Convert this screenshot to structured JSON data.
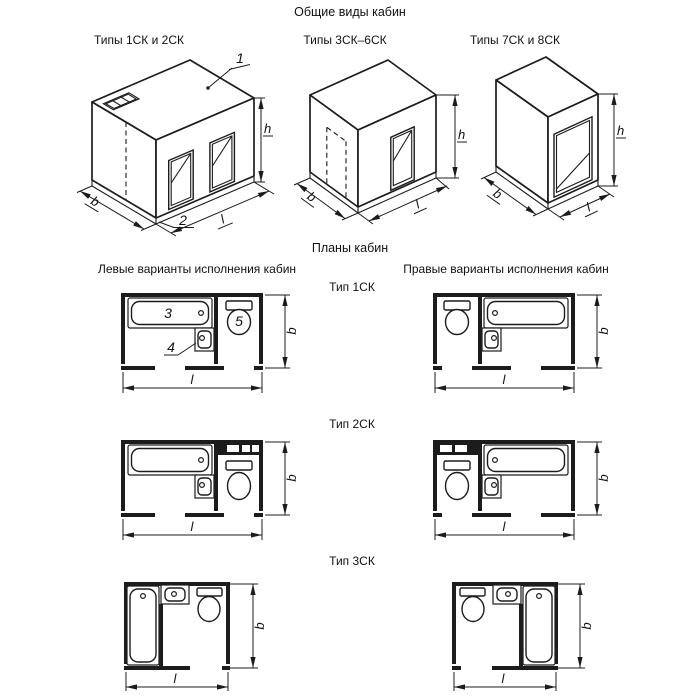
{
  "page": {
    "bg": "#ffffff",
    "ink": "#1c1c1c",
    "title": "Общие виды кабин",
    "plans_title": "Планы кабин",
    "left_variants_title": "Левые варианты исполнения кабин",
    "right_variants_title": "Правые варианты исполнения кабин"
  },
  "dim_labels": {
    "height": "h",
    "width": "b",
    "length": "l"
  },
  "views": [
    {
      "label": "Типы 1СК и 2СК",
      "callout_roof": "1",
      "callout_base": "2"
    },
    {
      "label": "Типы 3СК–6СК"
    },
    {
      "label": "Типы 7СК и 8СК"
    }
  ],
  "plan_rows": [
    {
      "label": "Тип 1СК",
      "callout_bath": "3",
      "callout_sink": "4",
      "callout_toilet": "5"
    },
    {
      "label": "Тип 2СК"
    },
    {
      "label": "Тип 3СК"
    }
  ]
}
